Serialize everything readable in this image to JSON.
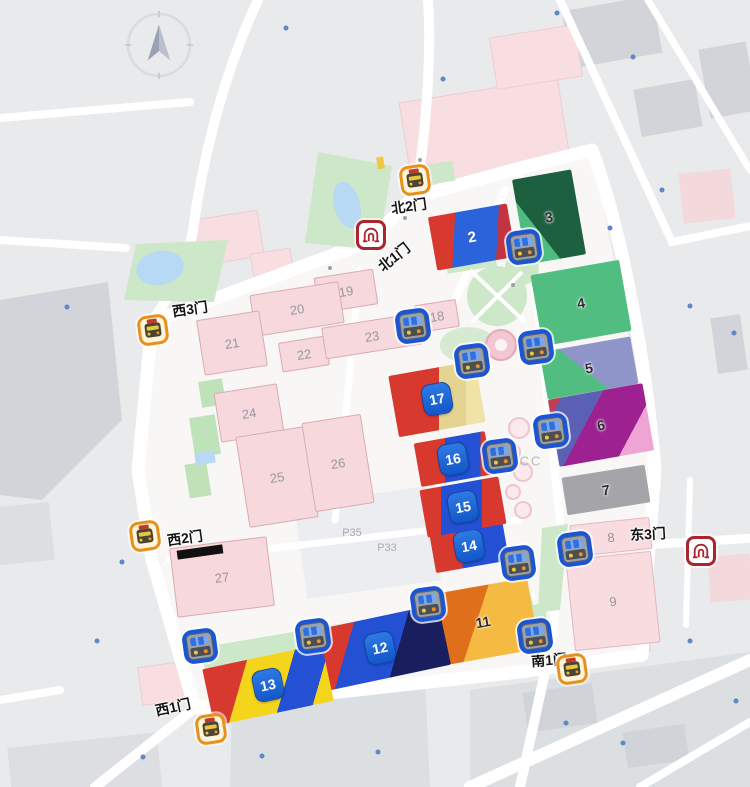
{
  "map": {
    "compass_name": "compass-north",
    "colors": {
      "background": "#e9eaec",
      "campus": "#f8f7f6",
      "road": "#ffffff",
      "pink_hall": "#f7d9dd",
      "badge_blue": "#1a64d9",
      "bus_border": "#1b55d6",
      "shuttle_border": "#e8901c",
      "metro_border": "#ab2430"
    },
    "halls": [
      {
        "id": "2",
        "label": "2",
        "label_style": "white",
        "x": 472,
        "y": 237,
        "w": 80,
        "h": 54,
        "rot": -10,
        "bg": "linear-gradient(103deg,#d8392f 30%,#2b63da 30% 78%,#c23540 78%)"
      },
      {
        "id": "3",
        "label": "3",
        "label_style": "dark",
        "x": 549,
        "y": 217,
        "w": 60,
        "h": 86,
        "rot": -10,
        "bg": "linear-gradient(62deg,#4ebc7e 32%,#1d6040 32%)"
      },
      {
        "id": "4",
        "label": "4",
        "label_style": "dark",
        "x": 581,
        "y": 303,
        "w": 90,
        "h": 72,
        "rot": -10,
        "bg": "#52bd80"
      },
      {
        "id": "5",
        "label": "5",
        "label_style": "dark",
        "x": 589,
        "y": 368,
        "w": 92,
        "h": 48,
        "rot": -10,
        "bg": "linear-gradient(48deg,#52bd80 46%,#9095c9 46%)"
      },
      {
        "id": "6",
        "label": "6",
        "label_style": "dark",
        "x": 601,
        "y": 425,
        "w": 96,
        "h": 68,
        "rot": -10,
        "bg": "linear-gradient(128deg,#c53b52 9%,#5c60b4 9% 38%,#9d2190 38% 76%,#efa5d3 76%)"
      },
      {
        "id": "7",
        "label": "7",
        "label_style": "dark",
        "x": 606,
        "y": 490,
        "w": 84,
        "h": 38,
        "rot": -9,
        "bg": "#a5a5a9"
      },
      {
        "id": "8",
        "label": "8",
        "label_style": "gray",
        "x": 611,
        "y": 537,
        "w": 80,
        "h": 32,
        "rot": -6,
        "bg": "#f8dce0",
        "border": "#e2b9c0"
      },
      {
        "id": "9",
        "label": "9",
        "label_style": "gray",
        "x": 613,
        "y": 601,
        "w": 86,
        "h": 92,
        "rot": -6,
        "bg": "#f8dce0",
        "border": "#e2b9c0"
      },
      {
        "id": "11",
        "label": "11",
        "label_style": "dark",
        "x": 483,
        "y": 622,
        "w": 102,
        "h": 72,
        "rot": -10,
        "bg": "linear-gradient(118deg,#e06f1c 45%,#f4ba41 45%)"
      },
      {
        "id": "12",
        "badge": "12",
        "x": 380,
        "y": 648,
        "w": 132,
        "h": 62,
        "rot": -12,
        "bg": "linear-gradient(118deg,#d8392f 28%,#2450d4 28% 62%,#191f5e 62%)"
      },
      {
        "id": "13",
        "badge": "13",
        "x": 268,
        "y": 685,
        "w": 122,
        "h": 58,
        "rot": -12,
        "bg": "linear-gradient(118deg,#d8392f 30%,#f5d51b 30% 62%,#2450d4 62% 86%,#f5d51b 86%)"
      },
      {
        "id": "14",
        "badge": "14",
        "x": 469,
        "y": 546,
        "w": 74,
        "h": 42,
        "rot": -10,
        "bg": "linear-gradient(100deg,#d8392f 42%,#2450d4 42%)"
      },
      {
        "id": "15",
        "badge": "15",
        "x": 463,
        "y": 507,
        "w": 80,
        "h": 48,
        "rot": -10,
        "bg": "linear-gradient(100deg,#d8392f 25%,#2450d4 25% 72%,#d8392f 72%)"
      },
      {
        "id": "16",
        "badge": "16",
        "x": 453,
        "y": 459,
        "w": 72,
        "h": 44,
        "rot": -10,
        "bg": "linear-gradient(100deg,#d8392f 40%,#2450d4 40% 85%,#d8392f 85%)"
      },
      {
        "id": "17",
        "badge": "17",
        "x": 437,
        "y": 399,
        "w": 88,
        "h": 62,
        "rot": -10,
        "bg": "linear-gradient(100deg,#d8392f 52%,#e5d391 52% 80%,#f0e3a8 80%)"
      },
      {
        "id": "18",
        "label": "18",
        "label_style": "pink",
        "x": 437,
        "y": 316,
        "w": 42,
        "h": 28,
        "rot": -9,
        "bg": "#f7d9dd",
        "border": "#d9abb2"
      },
      {
        "id": "19",
        "label": "19",
        "label_style": "pink",
        "x": 346,
        "y": 291,
        "w": 60,
        "h": 36,
        "rot": -9,
        "bg": "#f7d9dd",
        "border": "#d9abb2"
      },
      {
        "id": "20",
        "label": "20",
        "label_style": "pink",
        "x": 297,
        "y": 309,
        "w": 90,
        "h": 42,
        "rot": -9,
        "bg": "#f7d9dd",
        "border": "#d9abb2"
      },
      {
        "id": "21",
        "label": "21",
        "label_style": "pink",
        "x": 232,
        "y": 343,
        "w": 64,
        "h": 56,
        "rot": -9,
        "bg": "#f7d9dd",
        "border": "#d9abb2"
      },
      {
        "id": "22",
        "label": "22",
        "label_style": "pink",
        "x": 304,
        "y": 354,
        "w": 48,
        "h": 30,
        "rot": -9,
        "bg": "#f7d9dd",
        "border": "#d9abb2"
      },
      {
        "id": "23",
        "label": "23",
        "label_style": "pink",
        "x": 372,
        "y": 336,
        "w": 98,
        "h": 32,
        "rot": -9,
        "bg": "#f7d9dd",
        "border": "#d9abb2"
      },
      {
        "id": "24",
        "label": "24",
        "label_style": "pink",
        "x": 249,
        "y": 413,
        "w": 64,
        "h": 50,
        "rot": -9,
        "bg": "#f7d9dd",
        "border": "#d9abb2"
      },
      {
        "id": "25",
        "label": "25",
        "label_style": "pink",
        "x": 277,
        "y": 477,
        "w": 70,
        "h": 92,
        "rot": -9,
        "bg": "#f7d9dd",
        "border": "#d9abb2"
      },
      {
        "id": "26",
        "label": "26",
        "label_style": "pink",
        "x": 338,
        "y": 463,
        "w": 60,
        "h": 90,
        "rot": -9,
        "bg": "#f7d9dd",
        "border": "#d9abb2"
      },
      {
        "id": "27",
        "label": "27",
        "label_style": "pink",
        "x": 222,
        "y": 577,
        "w": 98,
        "h": 70,
        "rot": -7,
        "bg": "#f7d9dd",
        "border": "#d9abb2"
      }
    ],
    "gates": [
      {
        "label": "北2门",
        "x": 409,
        "y": 206,
        "rot": -8
      },
      {
        "label": "北1门",
        "x": 394,
        "y": 257,
        "rot": -38
      },
      {
        "label": "西3门",
        "x": 190,
        "y": 309,
        "rot": -8
      },
      {
        "label": "西2门",
        "x": 185,
        "y": 538,
        "rot": -8,
        "bar": {
          "x": 200,
          "y": 552,
          "w": 46,
          "h": 9
        }
      },
      {
        "label": "西1门",
        "x": 173,
        "y": 707,
        "rot": -12
      },
      {
        "label": "南1门",
        "x": 549,
        "y": 660,
        "rot": -4
      },
      {
        "label": "东3门",
        "x": 648,
        "y": 534,
        "rot": -3
      }
    ],
    "stations": {
      "bus": [
        {
          "x": 524,
          "y": 247
        },
        {
          "x": 413,
          "y": 326
        },
        {
          "x": 472,
          "y": 361
        },
        {
          "x": 536,
          "y": 347
        },
        {
          "x": 551,
          "y": 431
        },
        {
          "x": 500,
          "y": 456
        },
        {
          "x": 518,
          "y": 563
        },
        {
          "x": 575,
          "y": 549
        },
        {
          "x": 428,
          "y": 604
        },
        {
          "x": 313,
          "y": 636
        },
        {
          "x": 200,
          "y": 646
        },
        {
          "x": 535,
          "y": 636
        }
      ],
      "shuttle": [
        {
          "x": 415,
          "y": 180
        },
        {
          "x": 153,
          "y": 330
        },
        {
          "x": 145,
          "y": 536
        },
        {
          "x": 211,
          "y": 729
        },
        {
          "x": 572,
          "y": 669
        }
      ],
      "metro": [
        {
          "x": 371,
          "y": 235
        },
        {
          "x": 701,
          "y": 551
        }
      ]
    },
    "area_labels": [
      {
        "text": "CC",
        "x": 531,
        "y": 461,
        "small": false
      },
      {
        "text": "P35",
        "x": 352,
        "y": 533,
        "small": true
      },
      {
        "text": "P33",
        "x": 387,
        "y": 548,
        "small": true
      }
    ]
  }
}
